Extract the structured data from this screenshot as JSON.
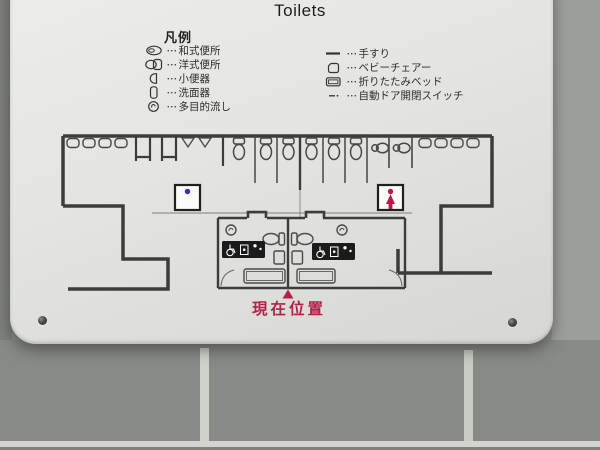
{
  "sign": {
    "title": "Toilets",
    "legend": {
      "heading": "凡例",
      "dots": "･･･",
      "left_items": [
        {
          "icon": "squat-toilet-icon",
          "label": "和式便所"
        },
        {
          "icon": "western-toilet-icon",
          "label": "洋式便所"
        },
        {
          "icon": "urinal-icon",
          "label": "小便器"
        },
        {
          "icon": "washbasin-icon",
          "label": "洗面器"
        },
        {
          "icon": "multipurpose-sink-icon",
          "label": "多目的流し"
        }
      ],
      "right_items": [
        {
          "icon": "handrail-icon",
          "label": "手すり"
        },
        {
          "icon": "baby-chair-icon",
          "label": "ベビーチェアー"
        },
        {
          "icon": "folding-bed-icon",
          "label": "折りたたみベッド"
        },
        {
          "icon": "auto-door-switch-icon",
          "label": "自動ドア開閉スイッチ"
        }
      ]
    },
    "floor_plan": {
      "current_location_label": "現在位置",
      "mens_symbol": "male-pictogram",
      "womens_symbol": "female-pictogram",
      "accessible_room_icons": [
        "wheelchair",
        "changing-table",
        "parent-and-child"
      ]
    },
    "colors": {
      "male_blue": "#2f2fb4",
      "female_red": "#bf1746",
      "marker_red": "#b41f45",
      "plan_line": "#3c3c3c",
      "sign_face": "#e4e5e1",
      "tile_wall": "#8d908c"
    }
  }
}
